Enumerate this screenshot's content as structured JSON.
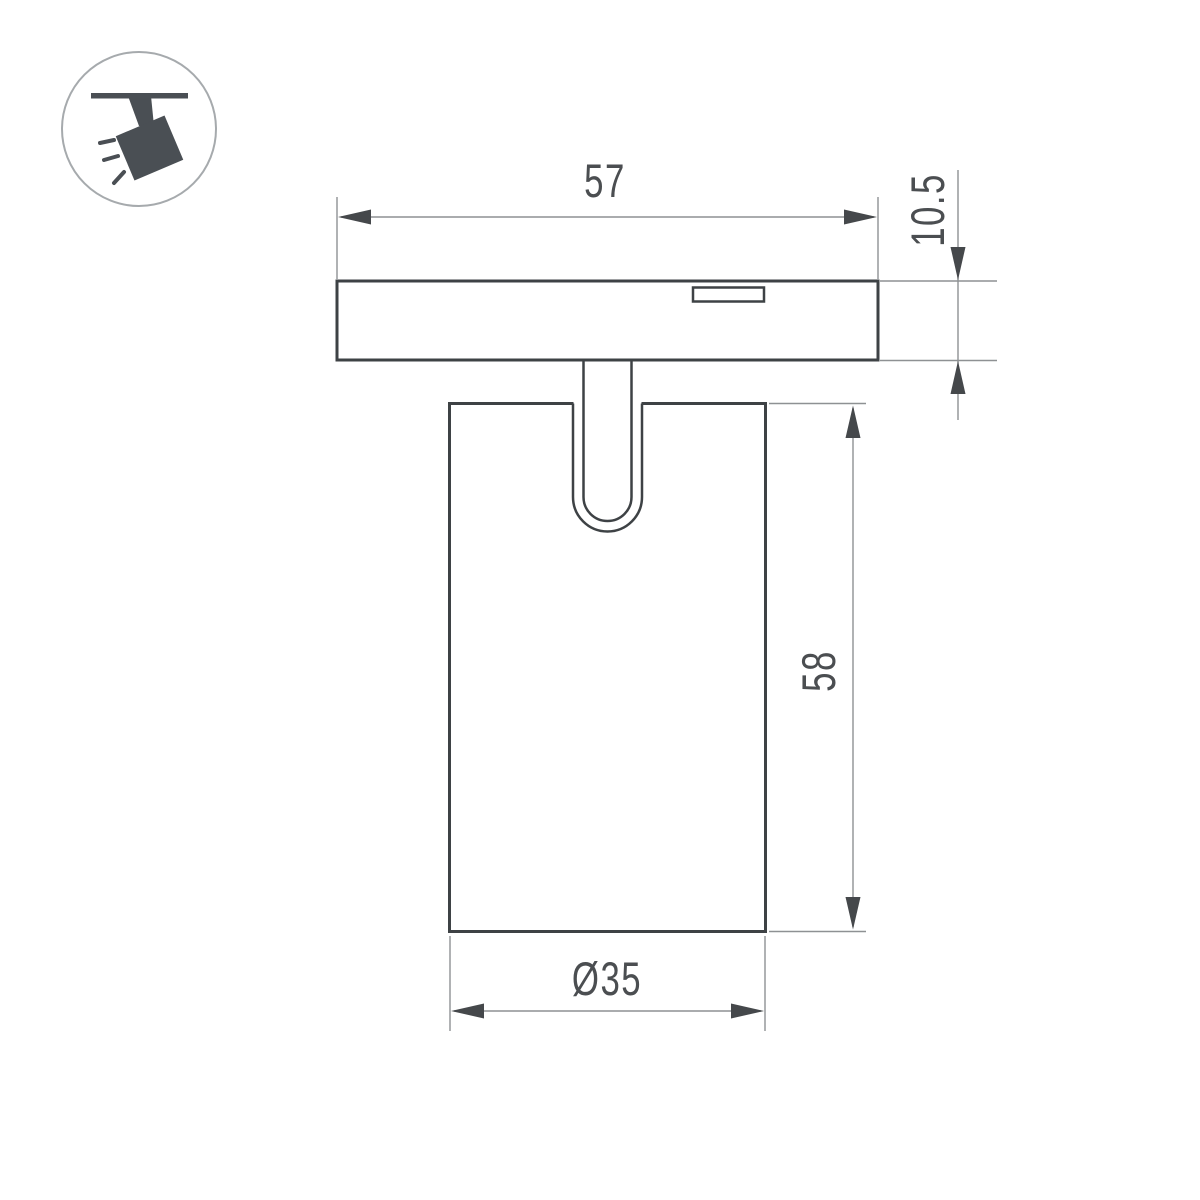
{
  "title": "Track spotlight dimension drawing",
  "icon": {
    "name": "ceiling-track-spotlight"
  },
  "dimensions": {
    "track_width": "57",
    "base_height": "10.5",
    "body_height": "58",
    "body_diameter": "Ø35"
  },
  "colors": {
    "bg": "#ffffff",
    "outline": "#3e4245",
    "dimline": "#8e9193",
    "arrow": "#45484b",
    "text": "#4b4e51",
    "icon": "#4a4f54",
    "iconborder": "#a6aaad"
  }
}
